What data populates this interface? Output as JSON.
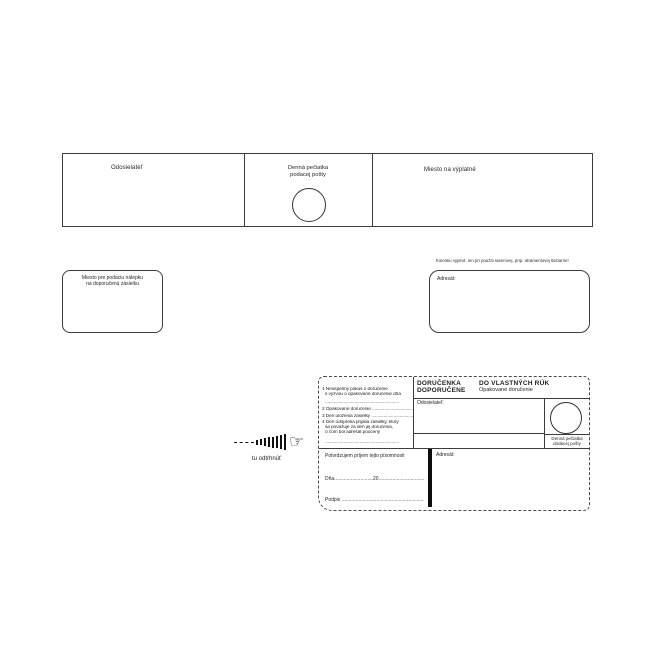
{
  "colors": {
    "background": "#ffffff",
    "ink": "#1f1f1f",
    "line": "#3c3c3c"
  },
  "strip": {
    "sender_label": "Odosielateľ",
    "stamp_label_line1": "Denná pečiatka",
    "stamp_label_line2": "podacej pošty",
    "postage_label": "Miesto na výplatné"
  },
  "middle_row": {
    "sticker_box_line1": "Miesto pre podaciu nálepku",
    "sticker_box_line2": "na doporučenú zásielku",
    "printer_note": "Kolónku vyplniť, len pri použití laserovej, príp. atramentovej tlačiarne!",
    "addressee_label": "Adresát:"
  },
  "tear_off": {
    "hand_icon": "☞",
    "label": "tu odtrhnúť"
  },
  "delivery_form": {
    "title_line1": "DORUČENKA",
    "title_line2": "DOPORUČENE",
    "subtitle_line1": "DO VLASTNÝCH RÚK",
    "subtitle_line2": "Opakované doručenie",
    "sender_label": "Odosielateľ:",
    "addressee_label": "Adresát:",
    "stamp_label_line1": "Denná pečiatka",
    "stamp_label_line2": "dodacej pošty",
    "notes": [
      "1 Neúspešný pokus o doručenie",
      "s výzvou o opakované doručenie dňa",
      "............................................................",
      "2 Opakované doručenie ............................................",
      "3 Deň uloženia zásielky ...........................................",
      "4 Deň odopretia prijatia zásielky, ktorý",
      "sa považuje za deň jej doručenia,",
      "o čom bol adresát poučený",
      "............................................................"
    ],
    "confirm_label": "Potvrdzujem príjem tejto písomnosti",
    "date_label": "Dňa....................................",
    "year_label": "20....................................",
    "signature_label": "Podpis ..........................................................."
  }
}
